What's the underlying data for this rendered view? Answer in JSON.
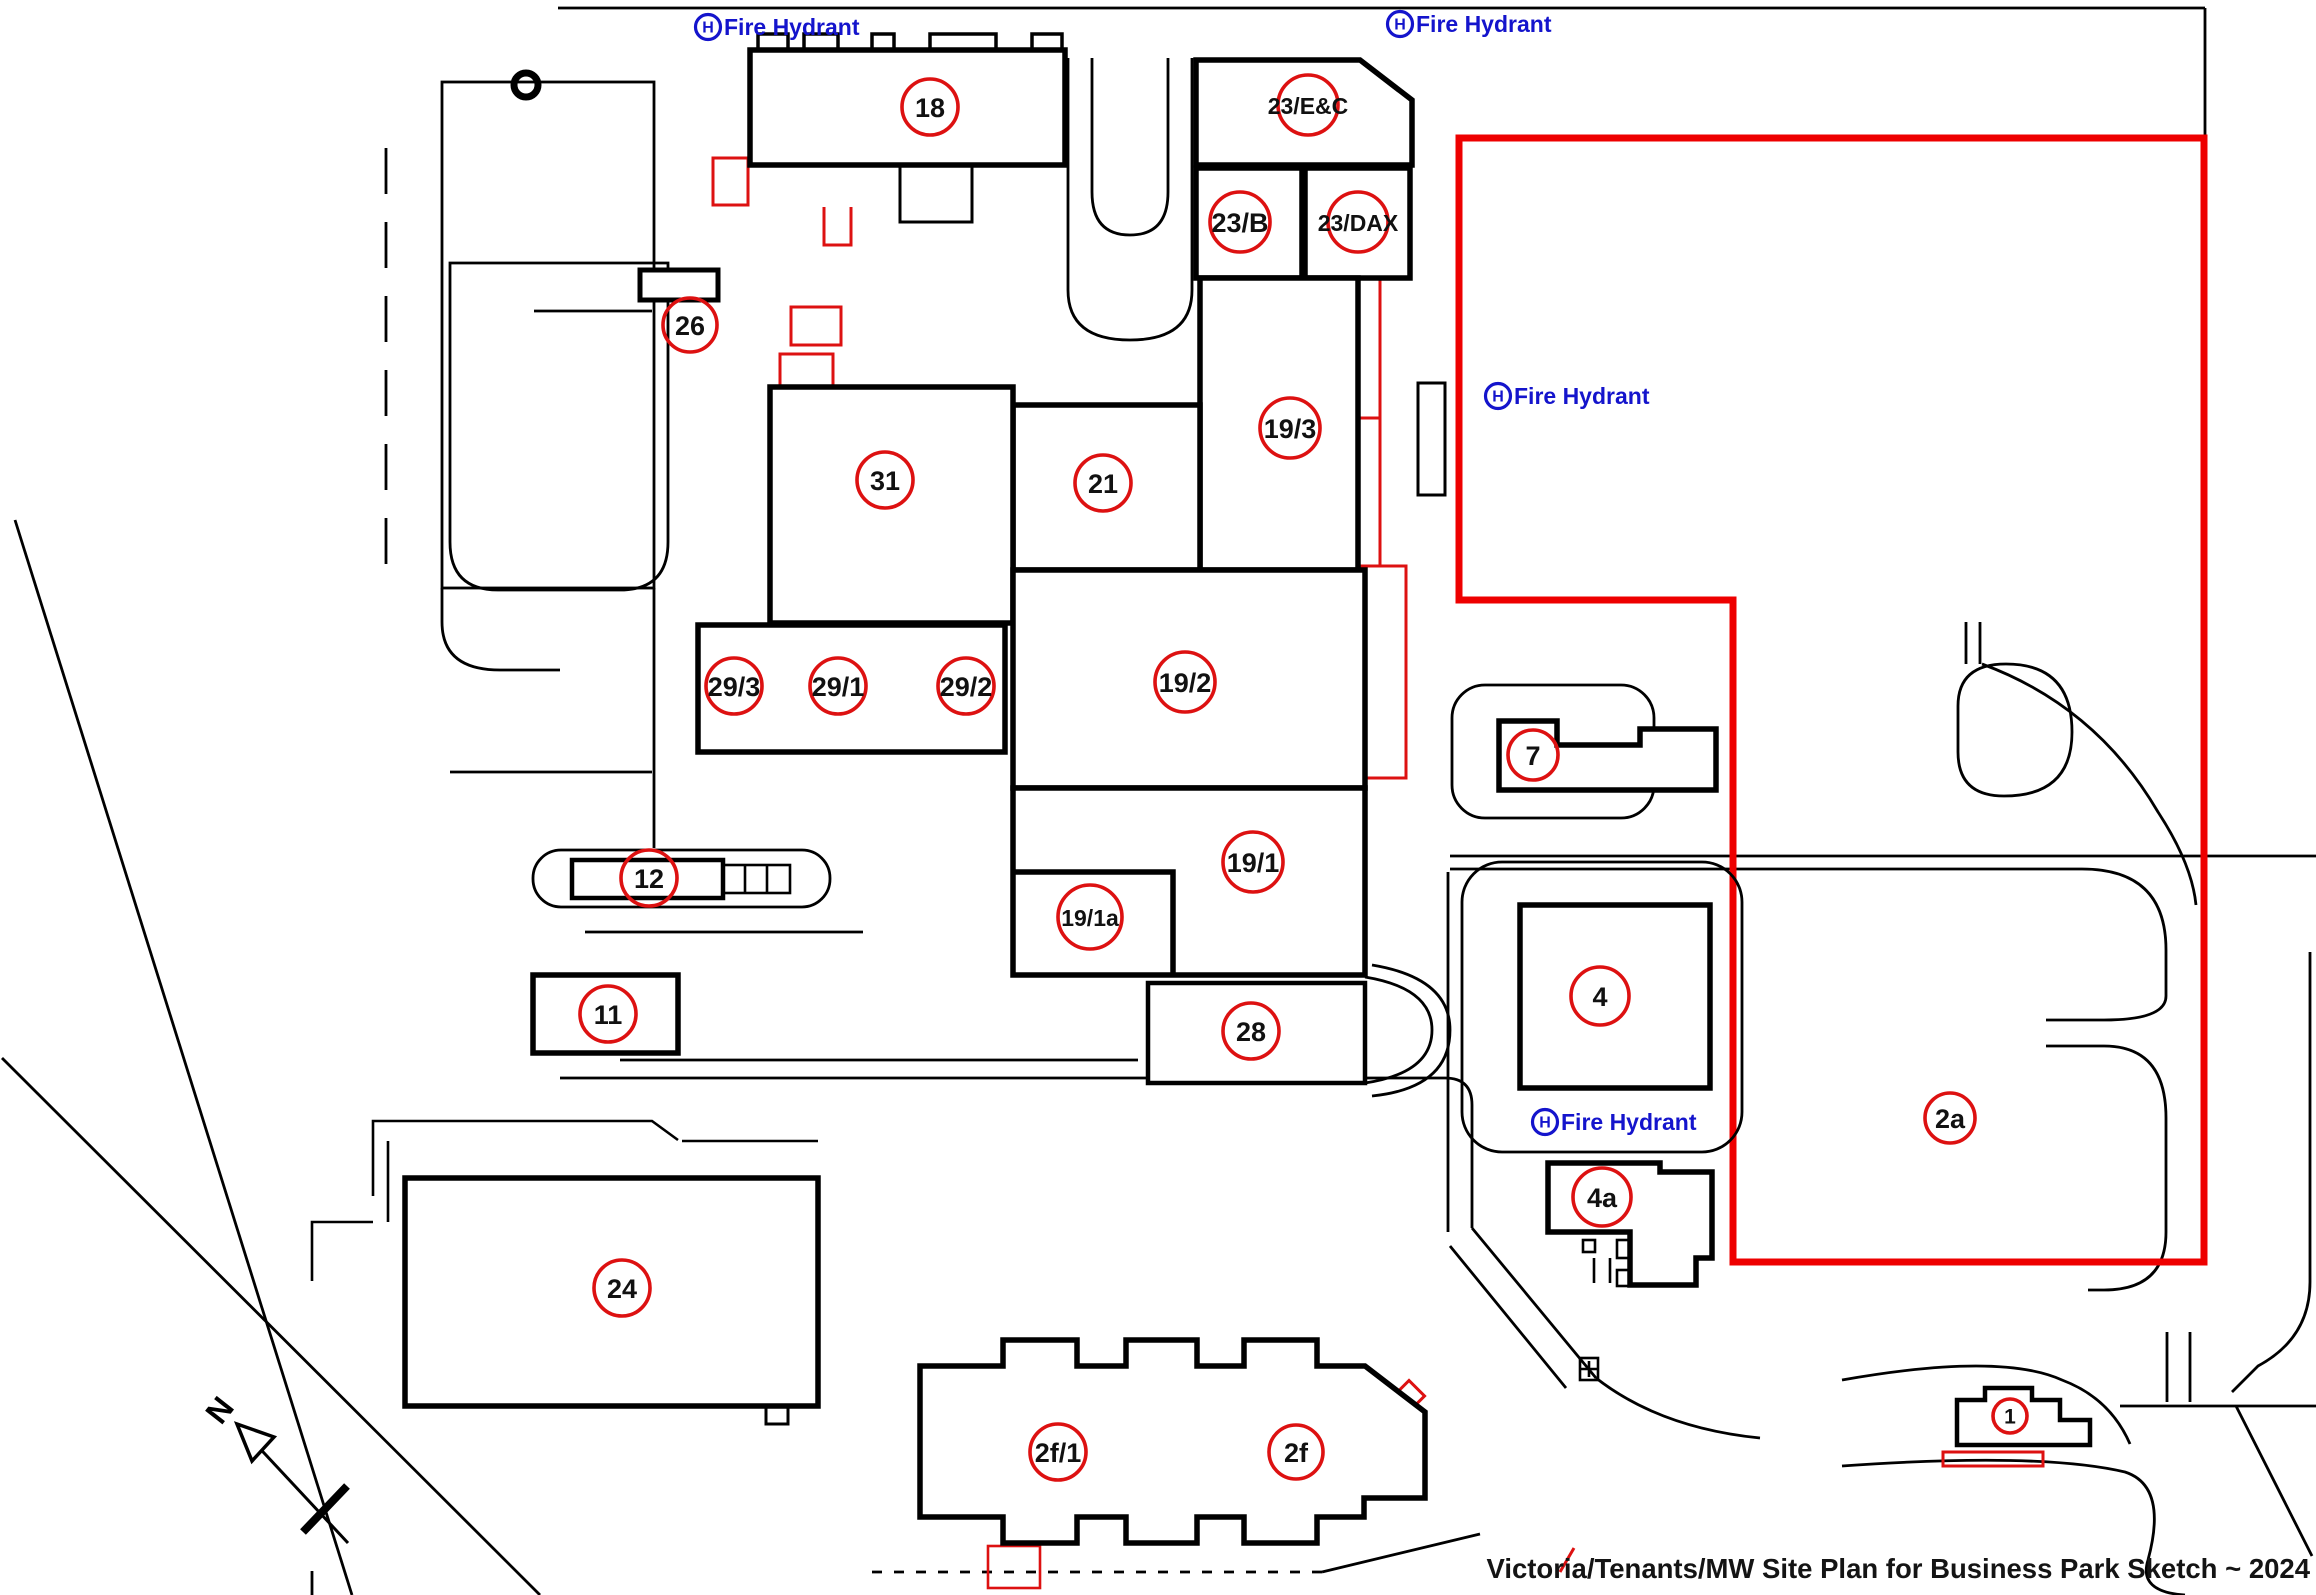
{
  "title": "Victoria/Tenants/MW Site Plan for Business Park Sketch ~ 2024",
  "north_label": "N",
  "hydrant": {
    "symbol": "H",
    "label": "Fire Hydrant"
  },
  "colors": {
    "line_black": "#000000",
    "annotation_red": "#dd1111",
    "boundary_red": "#ee0000",
    "hydrant_blue": "#1414cc",
    "text_black": "#111111",
    "fill_white": "#ffffff"
  },
  "fire_hydrants": [
    {
      "x": 708,
      "y": 27
    },
    {
      "x": 1400,
      "y": 24
    },
    {
      "x": 1498,
      "y": 396
    },
    {
      "x": 1545,
      "y": 1122
    }
  ],
  "buildings": [
    {
      "label": "18",
      "x": 930,
      "y": 107,
      "r": 28
    },
    {
      "label": "23/E&C",
      "x": 1308,
      "y": 105,
      "r": 30
    },
    {
      "label": "23/B",
      "x": 1240,
      "y": 222,
      "r": 30
    },
    {
      "label": "23/DAX",
      "x": 1358,
      "y": 222,
      "r": 30
    },
    {
      "label": "26",
      "x": 690,
      "y": 325,
      "r": 27
    },
    {
      "label": "31",
      "x": 885,
      "y": 480,
      "r": 28
    },
    {
      "label": "21",
      "x": 1103,
      "y": 483,
      "r": 28
    },
    {
      "label": "19/3",
      "x": 1290,
      "y": 428,
      "r": 30
    },
    {
      "label": "29/3",
      "x": 734,
      "y": 686,
      "r": 28
    },
    {
      "label": "29/1",
      "x": 838,
      "y": 686,
      "r": 28
    },
    {
      "label": "29/2",
      "x": 966,
      "y": 686,
      "r": 28
    },
    {
      "label": "19/2",
      "x": 1185,
      "y": 682,
      "r": 30
    },
    {
      "label": "7",
      "x": 1533,
      "y": 755,
      "r": 25
    },
    {
      "label": "12",
      "x": 649,
      "y": 878,
      "r": 28
    },
    {
      "label": "19/1",
      "x": 1253,
      "y": 862,
      "r": 30
    },
    {
      "label": "19/1a",
      "x": 1090,
      "y": 917,
      "r": 32
    },
    {
      "label": "11",
      "x": 608,
      "y": 1014,
      "r": 28
    },
    {
      "label": "28",
      "x": 1251,
      "y": 1031,
      "r": 28
    },
    {
      "label": "4",
      "x": 1600,
      "y": 996,
      "r": 29
    },
    {
      "label": "4a",
      "x": 1602,
      "y": 1197,
      "r": 29
    },
    {
      "label": "24",
      "x": 622,
      "y": 1288,
      "r": 28
    },
    {
      "label": "2a",
      "x": 1950,
      "y": 1118,
      "r": 25
    },
    {
      "label": "2f/1",
      "x": 1058,
      "y": 1452,
      "r": 28
    },
    {
      "label": "2f",
      "x": 1296,
      "y": 1452,
      "r": 27
    },
    {
      "label": "1",
      "x": 2010,
      "y": 1416,
      "r": 17
    }
  ]
}
